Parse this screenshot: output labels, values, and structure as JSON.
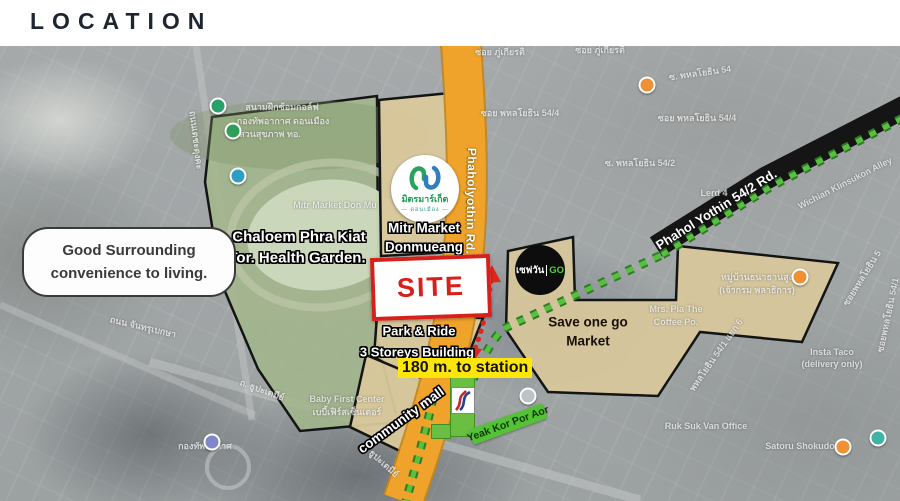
{
  "header": {
    "title": "LOCATION"
  },
  "callout": {
    "line1": "Good Surrounding",
    "line2": "convenience to living."
  },
  "colors": {
    "site_red": "#d6201b",
    "road_yellow": "#efa32a",
    "route_green": "#57c13e",
    "highlight_yellow": "#ffe60a",
    "station_green": "#6abf42",
    "road_black": "#151515"
  },
  "map": {
    "roads": {
      "phaholyothin": "Phaholyothin Rd.",
      "phahol_54_2": "Phahol Yothin 54/2 Rd."
    },
    "park": {
      "line1": "Chaloem Phra Kiat",
      "line2": "Tor. Health Garden."
    },
    "mitr": {
      "line1": "Mitr Market",
      "line2": "Donmueang",
      "logo_thai": "มิตรมาร์เก็ต",
      "logo_sub": "— ดอนเมือง —"
    },
    "site": {
      "label": "SITE"
    },
    "park_ride": {
      "line1": "Park & Ride",
      "line2": "3 Storeys Building"
    },
    "distance": {
      "label": "180 m.  to station"
    },
    "community_mall": {
      "label": "community mall"
    },
    "save_one": {
      "line1": "Save one go",
      "line2": "Market",
      "logo_thai": "เซฟวัน",
      "logo_go": "GO"
    },
    "station": {
      "banner": "Yeak Kor Por Aor"
    },
    "bg_labels": [
      {
        "t": "ซอย ภู่เกียรติ",
        "x": 500,
        "y": 52,
        "r": 0
      },
      {
        "t": "ซอย ภู่เกียรติ",
        "x": 600,
        "y": 50,
        "r": 0
      },
      {
        "t": "ซอย พหลโยธิน 54/4",
        "x": 520,
        "y": 113,
        "r": 0
      },
      {
        "t": "ซอย พหลโยธิน 54/4",
        "x": 697,
        "y": 118,
        "r": 0
      },
      {
        "t": "ซ. พหลโยธิน 54",
        "x": 700,
        "y": 73,
        "r": -8
      },
      {
        "t": "ซ. พหลโยธิน 54/2",
        "x": 640,
        "y": 163,
        "r": 0
      },
      {
        "t": "Lerd 4",
        "x": 714,
        "y": 193,
        "r": 0
      },
      {
        "t": "Wichian Klinsukon Alley",
        "x": 845,
        "y": 183,
        "r": -27
      },
      {
        "t": "หมู่บ้านธนาธานสูง",
        "x": 757,
        "y": 277,
        "r": 0
      },
      {
        "t": "(เจ้ากรม พลาธิการ)",
        "x": 757,
        "y": 290,
        "r": 0
      },
      {
        "t": "Insta Taco",
        "x": 832,
        "y": 352,
        "r": 0
      },
      {
        "t": "(delivery only)",
        "x": 832,
        "y": 364,
        "r": 0
      },
      {
        "t": "Ruk Suk Van Office",
        "x": 706,
        "y": 426,
        "r": 0
      },
      {
        "t": "Satoru Shokudo",
        "x": 800,
        "y": 446,
        "r": 0
      },
      {
        "t": "Baby First Center",
        "x": 347,
        "y": 399,
        "r": 0
      },
      {
        "t": "เบบี้เฟิร์สเซ็นเตอร์",
        "x": 347,
        "y": 412,
        "r": 0
      },
      {
        "t": "ถ. ธูปะเตมีย์",
        "x": 262,
        "y": 390,
        "r": 20
      },
      {
        "t": "ถ. ธูปะเตมีย์",
        "x": 380,
        "y": 460,
        "r": 42
      },
      {
        "t": "ถนน จันทรุเบกษา",
        "x": 143,
        "y": 327,
        "r": 13
      },
      {
        "t": "ถนนเตชะตุงคะ",
        "x": 196,
        "y": 140,
        "r": 83
      },
      {
        "t": "ซอยพหลโยธิน 5",
        "x": 862,
        "y": 278,
        "r": -58
      },
      {
        "t": "พหลโยธิน 54/1 แยก 6",
        "x": 716,
        "y": 355,
        "r": -55
      },
      {
        "t": "ซอยพหลโยธิน 54/1",
        "x": 888,
        "y": 315,
        "r": -78
      },
      {
        "t": "สนามฝึกซ้อมกอล์ฟ",
        "x": 282,
        "y": 107,
        "r": 0
      },
      {
        "t": "กองทัพอากาศ ดอนเมือง",
        "x": 283,
        "y": 121,
        "r": 0
      },
      {
        "t": "สวนสุขภาพ ทอ.",
        "x": 270,
        "y": 134,
        "r": 0
      },
      {
        "t": "Mitr Market Don Mu",
        "x": 335,
        "y": 205,
        "r": 0
      },
      {
        "t": "Mrs. Pia The",
        "x": 676,
        "y": 309,
        "r": 0
      },
      {
        "t": "Coffee Po.",
        "x": 676,
        "y": 322,
        "r": 0
      },
      {
        "t": "กองทัพอากาศ",
        "x": 205,
        "y": 446,
        "r": 0
      }
    ],
    "pins": [
      {
        "x": 218,
        "y": 106,
        "c": "#27a06b"
      },
      {
        "x": 233,
        "y": 131,
        "c": "#2f9e58"
      },
      {
        "x": 238,
        "y": 176,
        "c": "#2d9fc0"
      },
      {
        "x": 647,
        "y": 85,
        "c": "#ef9035"
      },
      {
        "x": 800,
        "y": 277,
        "c": "#ef9035"
      },
      {
        "x": 843,
        "y": 447,
        "c": "#ef9035"
      },
      {
        "x": 212,
        "y": 442,
        "c": "#8087c9"
      },
      {
        "x": 528,
        "y": 396,
        "c": "#bcc3c6"
      },
      {
        "x": 878,
        "y": 438,
        "c": "#3fb3a4"
      }
    ]
  }
}
